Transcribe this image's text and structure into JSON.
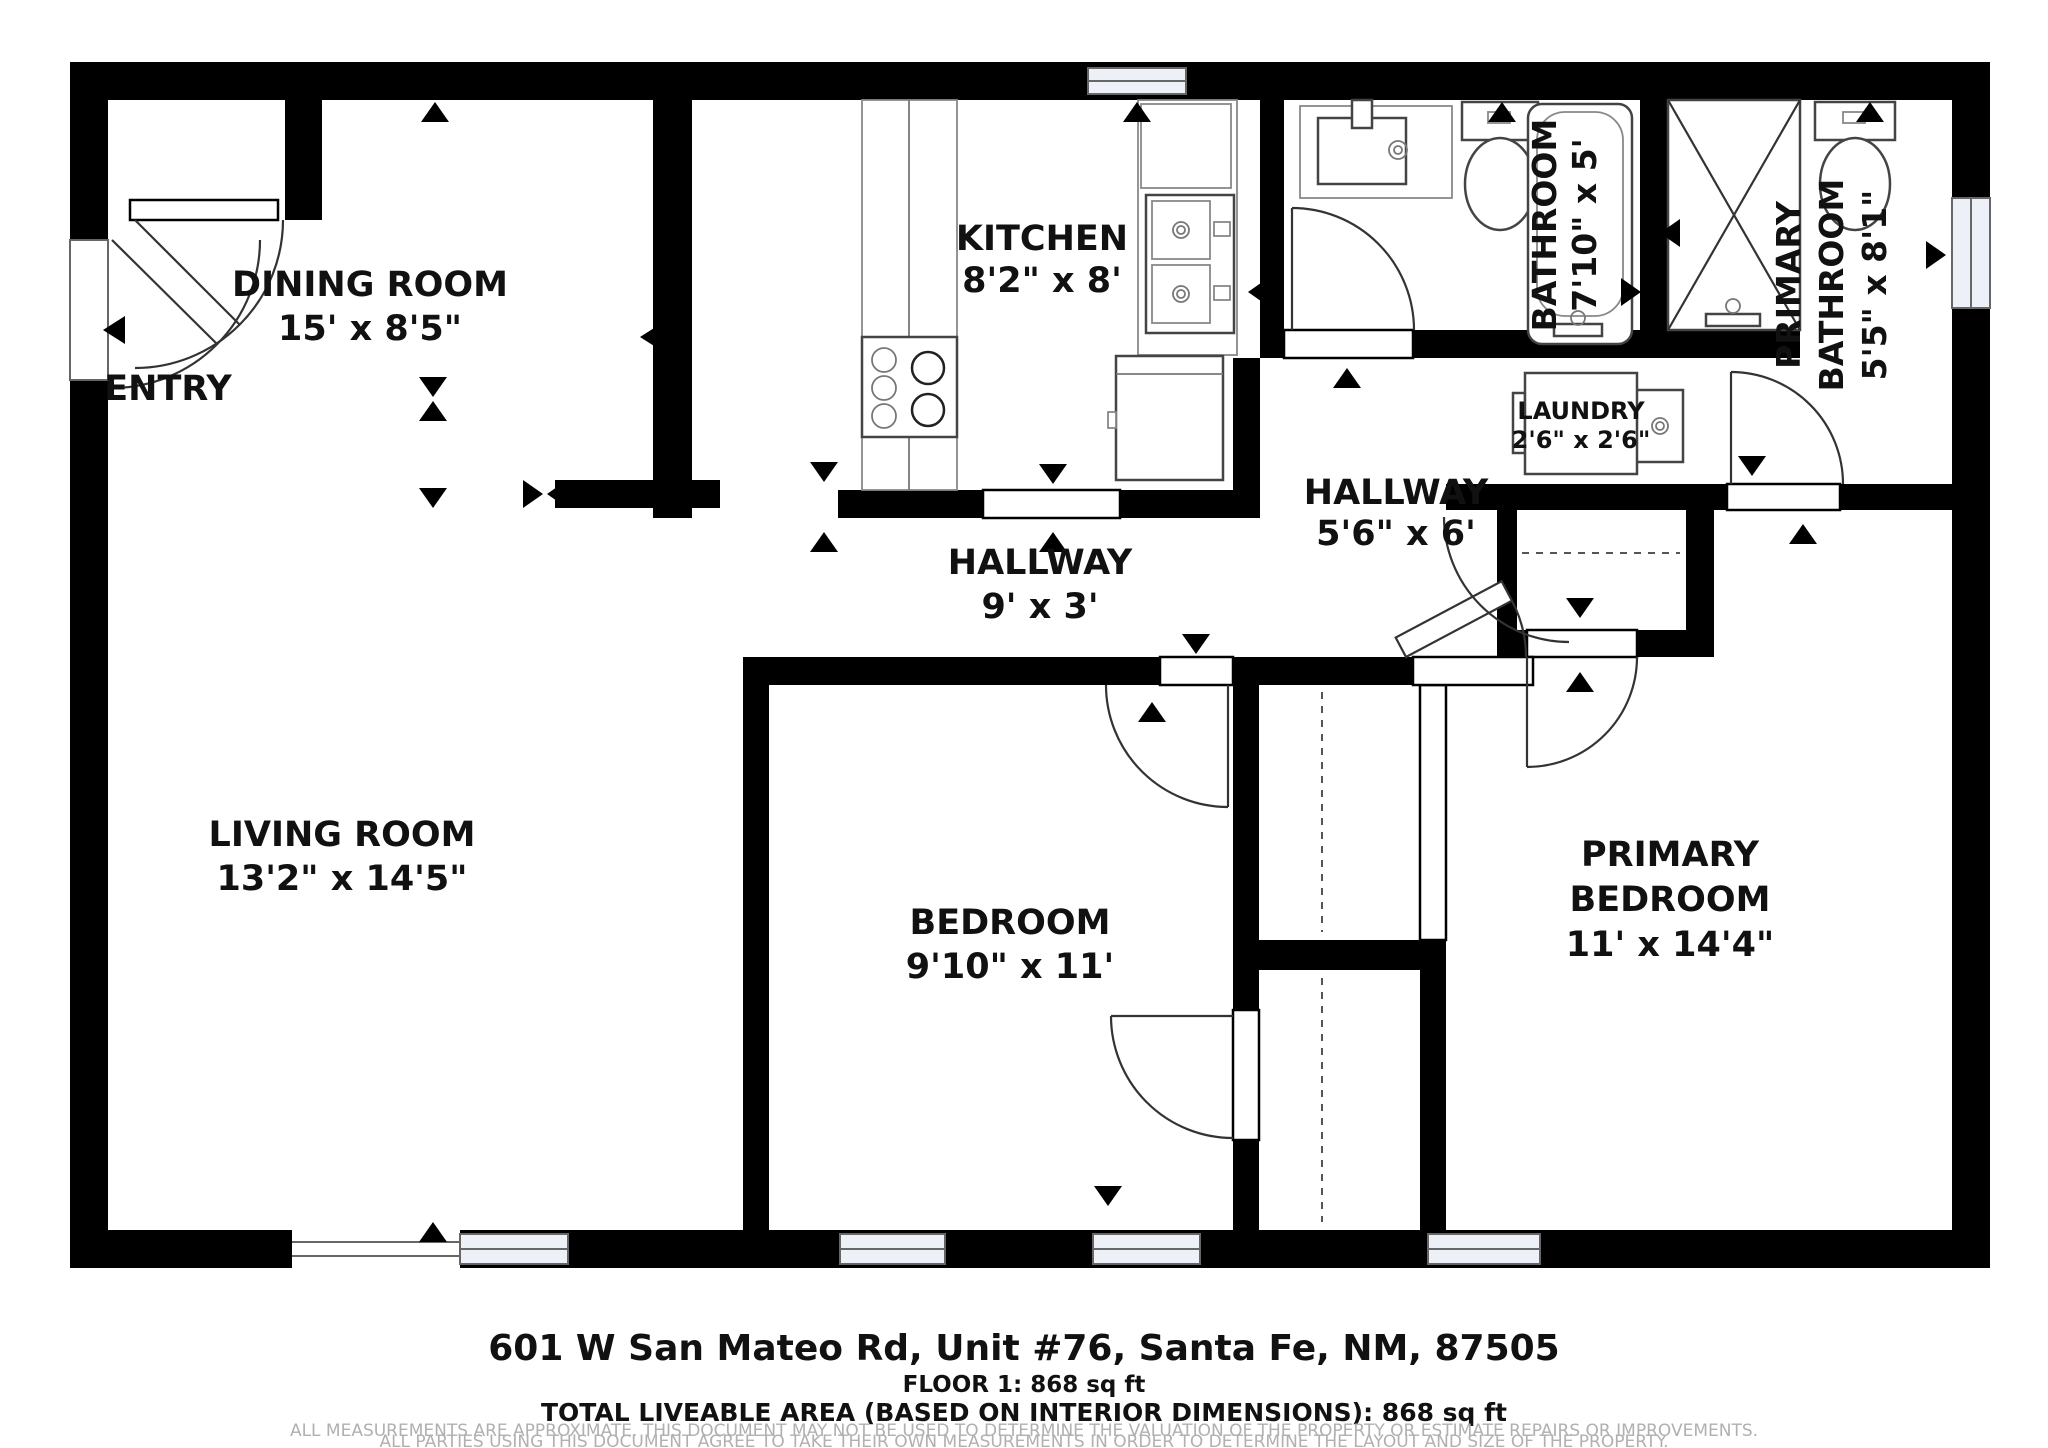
{
  "rooms": {
    "entry": {
      "name": "ENTRY"
    },
    "dining": {
      "name": "DINING ROOM",
      "dims": "15' x 8'5\""
    },
    "kitchen": {
      "name": "KITCHEN",
      "dims": "8'2\" x 8'"
    },
    "bathroom": {
      "name": "BATHROOM",
      "dims": "7'10\" x 5'"
    },
    "primary_bathroom": {
      "lines": [
        "PRIMARY",
        "BATHROOM"
      ],
      "dims": "5'5\" x 8'1\""
    },
    "laundry": {
      "name": "LAUNDRY",
      "dims": "2'6\" x 2'6\""
    },
    "hallway_upper": {
      "name": "HALLWAY",
      "dims": "5'6\" x 6'"
    },
    "hallway_lower": {
      "name": "HALLWAY",
      "dims": "9' x 3'"
    },
    "living": {
      "name": "LIVING ROOM",
      "dims": "13'2\" x 14'5\""
    },
    "bedroom": {
      "name": "BEDROOM",
      "dims": "9'10\" x 11'"
    },
    "primary_bedroom": {
      "lines": [
        "PRIMARY",
        "BEDROOM"
      ],
      "dims": "11' x 14'4\""
    }
  },
  "footer": {
    "address": "601 W San Mateo Rd, Unit #76, Santa Fe, NM, 87505",
    "floor_line": "FLOOR 1: 868 sq ft",
    "total_line": "TOTAL LIVEABLE AREA (BASED ON INTERIOR DIMENSIONS): 868 sq ft",
    "disclaimer_line1": "ALL MEASUREMENTS ARE APPROXIMATE. THIS DOCUMENT MAY NOT BE USED TO DETERMINE THE VALUATION OF THE PROPERTY OR ESTIMATE REPAIRS OR IMPROVEMENTS.",
    "disclaimer_line2": "ALL PARTIES USING THIS DOCUMENT AGREE TO TAKE THEIR OWN MEASUREMENTS IN ORDER TO DETERMINE THE LAYOUT AND SIZE OF THE PROPERTY."
  },
  "colors": {
    "wall": "#000000",
    "window_fill": "#eef0f8",
    "disclaimer_text": "#b0b0b0"
  }
}
